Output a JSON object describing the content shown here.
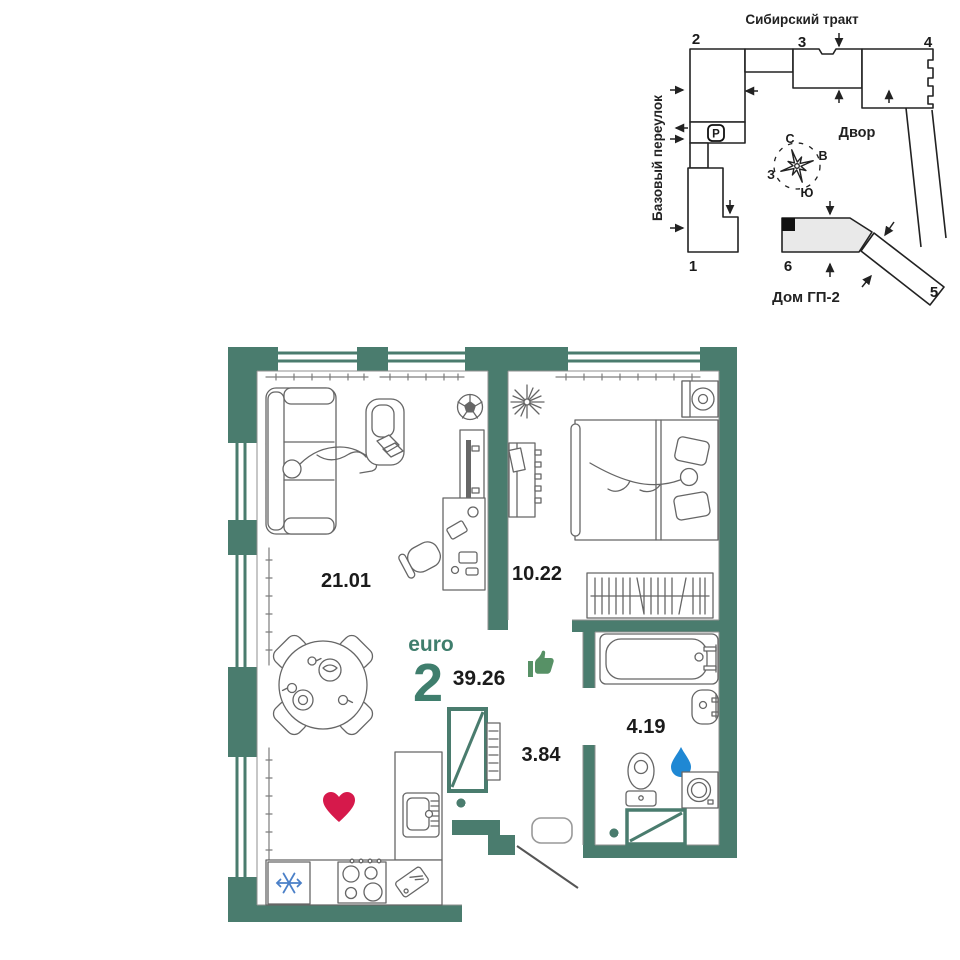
{
  "site_plan": {
    "street_top": "Сибирский тракт",
    "street_left": "Базовый переулок",
    "courtyard_label": "Двор",
    "house_label": "Дом ГП-2",
    "parking_label": "P",
    "building_numbers": [
      "1",
      "2",
      "3",
      "4",
      "5",
      "6"
    ],
    "compass": {
      "north": "С",
      "south": "Ю",
      "east": "В",
      "west": "З"
    }
  },
  "floor_plan": {
    "type_label": "euro",
    "rooms_count": "2",
    "total_area": "39.26",
    "rooms": [
      {
        "name": "living-room-kitchen",
        "area": "21.01"
      },
      {
        "name": "bedroom",
        "area": "10.22"
      },
      {
        "name": "hallway",
        "area": "3.84"
      },
      {
        "name": "bathroom",
        "area": "4.19"
      }
    ],
    "icons": {
      "heart": "heart-icon",
      "thumbs_up": "thumbs-up-icon",
      "water_drop": "water-drop-icon",
      "snowflake": "snowflake-icon",
      "parking": "parking-badge",
      "compass": "compass-rose"
    }
  },
  "colors": {
    "wall": "#4a7c6e",
    "accent": "#3f7e6d",
    "heart": "#d6194b",
    "drop": "#1f88d4",
    "snowflake": "#4b80c8",
    "thumb": "#579166",
    "building_fill": "#e9e9e9",
    "ink": "#1b1b1b",
    "furniture": "#666666"
  }
}
